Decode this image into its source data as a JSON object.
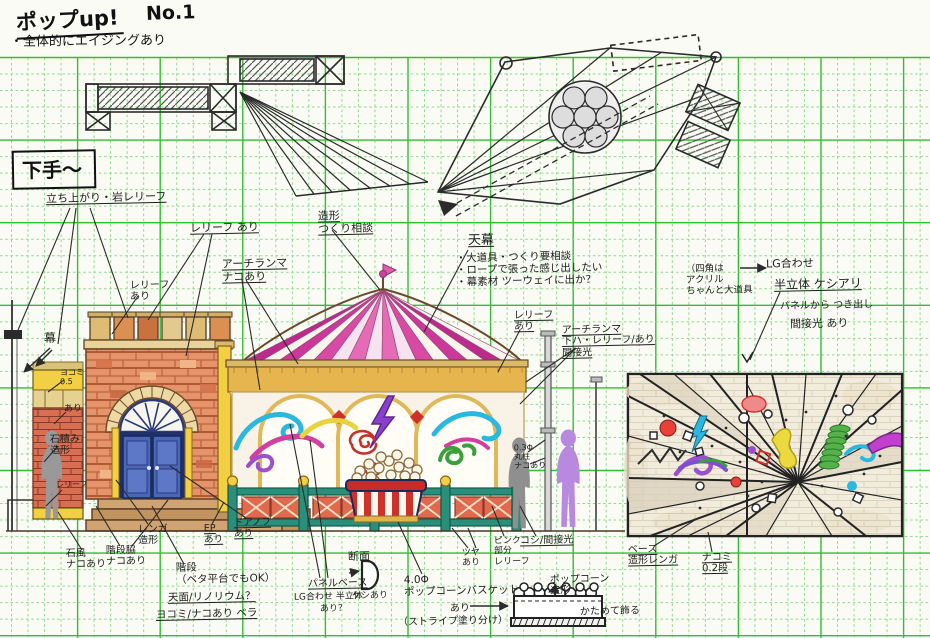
{
  "page": {
    "title": "ポップup!",
    "sheet_no": "No.1",
    "note": "・全体的にエイジングあり",
    "stage_side_label": "下手〜"
  },
  "colors": {
    "grid_major": "#2fbf2f",
    "grid_minor": "#8fd98f",
    "ink": "#2b2b2b",
    "tent_magenta": "#cb3899",
    "brick_orange": "#e5946a",
    "brick_red": "#d96f52",
    "trim_yellow": "#f2cf43",
    "awning_tan": "#e7b54e",
    "door_blue": "#4a66b8",
    "fence_red": "#e2694d",
    "rail_teal": "#2a8f7a",
    "accent_purple": "#8a3fd1",
    "accent_cyan": "#2ab7e0",
    "accent_green": "#3aa13a",
    "accent_red": "#d0302a",
    "silhouette_gray": "#8f8f8f",
    "silhouette_purple": "#b78ae0"
  },
  "annotations": [
    {
      "text": "立ち上がり・岩レリーフ",
      "x": 46,
      "y": 192,
      "fs": 11,
      "underline": true
    },
    {
      "text": "レリーフ あり",
      "x": 190,
      "y": 222,
      "fs": 11,
      "underline": true
    },
    {
      "text": "レリーフ\nあり",
      "x": 130,
      "y": 280,
      "fs": 10
    },
    {
      "text": "アーチランマ\nナコあり",
      "x": 222,
      "y": 258,
      "fs": 11,
      "underline": true
    },
    {
      "text": "造形\nつくり相談",
      "x": 318,
      "y": 210,
      "fs": 11,
      "underline": true
    },
    {
      "text": "天幕",
      "x": 468,
      "y": 234,
      "fs": 13,
      "underline": true
    },
    {
      "text": "・大道具・つくり要相談\n・ロープで張った感じ出したい\n・幕素材 ツーウェイに出か？",
      "x": 456,
      "y": 252,
      "fs": 10.5
    },
    {
      "text": "レリーフ\nあり",
      "x": 514,
      "y": 310,
      "fs": 10,
      "underline": true
    },
    {
      "text": "アーチランマ\n下ハ・レリーフ/あり\n間接光",
      "x": 562,
      "y": 324,
      "fs": 10,
      "underline": true
    },
    {
      "text": "（四角は\n アクリル\n ちゃんと大道具",
      "x": 686,
      "y": 264,
      "fs": 9.5
    },
    {
      "text": "LG合わせ",
      "x": 766,
      "y": 258,
      "fs": 11
    },
    {
      "text": "半立体 ケシアリ",
      "x": 774,
      "y": 278,
      "fs": 12,
      "underline": true
    },
    {
      "text": "パネルから つき出し",
      "x": 780,
      "y": 300,
      "fs": 10
    },
    {
      "text": "間接光 あり",
      "x": 790,
      "y": 318,
      "fs": 11
    },
    {
      "text": "幕",
      "x": 44,
      "y": 332,
      "fs": 12
    },
    {
      "text": "ヨコミ\n0.5",
      "x": 60,
      "y": 368,
      "fs": 8
    },
    {
      "text": "あり",
      "x": 64,
      "y": 404,
      "fs": 9
    },
    {
      "text": "石積み\n造形",
      "x": 50,
      "y": 434,
      "fs": 10
    },
    {
      "text": "レリーフ",
      "x": 56,
      "y": 480,
      "fs": 8
    },
    {
      "text": "石風\nナコあり",
      "x": 66,
      "y": 548,
      "fs": 10
    },
    {
      "text": "階段脇\nナコあり",
      "x": 106,
      "y": 545,
      "fs": 10
    },
    {
      "text": "レンガ\n造形",
      "x": 138,
      "y": 524,
      "fs": 10
    },
    {
      "text": "階段\n（ベタ平台でもOK）",
      "x": 176,
      "y": 562,
      "fs": 10.5
    },
    {
      "text": "天面/リノリウム？",
      "x": 168,
      "y": 592,
      "fs": 10.5,
      "underline": true
    },
    {
      "text": "ヨコミ/ナコあり ペラ",
      "x": 156,
      "y": 609,
      "fs": 10.5,
      "underline": true
    },
    {
      "text": "EP\nあり",
      "x": 204,
      "y": 524,
      "fs": 9.5,
      "underline": true
    },
    {
      "text": "ドアノブ\nあり",
      "x": 234,
      "y": 518,
      "fs": 9.5,
      "underline": true
    },
    {
      "text": "ツヤ\nあり",
      "x": 462,
      "y": 548,
      "fs": 9
    },
    {
      "text": "ピンク\n部分\nレリーフ",
      "x": 494,
      "y": 536,
      "fs": 9
    },
    {
      "text": "コシ/間接光",
      "x": 520,
      "y": 535,
      "fs": 10,
      "underline": true
    },
    {
      "text": "0.3Φ\n丸柱\nナコあり",
      "x": 514,
      "y": 443,
      "fs": 8
    },
    {
      "text": "断面",
      "x": 348,
      "y": 551,
      "fs": 11
    },
    {
      "text": "パネルベース",
      "x": 308,
      "y": 578,
      "fs": 10,
      "underline": true
    },
    {
      "text": "LG合わせ 半立体",
      "x": 294,
      "y": 592,
      "fs": 9
    },
    {
      "text": "ケシあり",
      "x": 352,
      "y": 591,
      "fs": 9
    },
    {
      "text": "あり？",
      "x": 320,
      "y": 604,
      "fs": 9
    },
    {
      "text": "4.0Φ\nポップコーンバスケット",
      "x": 404,
      "y": 574,
      "fs": 10.5
    },
    {
      "text": "あり",
      "x": 450,
      "y": 603,
      "fs": 10
    },
    {
      "text": "（ストライプ塗り分け）",
      "x": 398,
      "y": 616,
      "fs": 10
    },
    {
      "text": "ポップコーン\n造形",
      "x": 550,
      "y": 574,
      "fs": 10
    },
    {
      "text": "かためて飾る",
      "x": 580,
      "y": 606,
      "fs": 10
    },
    {
      "text": "ベース\n造形レンガ",
      "x": 628,
      "y": 544,
      "fs": 10,
      "underline": true
    },
    {
      "text": "ナコミ\n0.2段",
      "x": 702,
      "y": 552,
      "fs": 10,
      "underline": true
    }
  ]
}
